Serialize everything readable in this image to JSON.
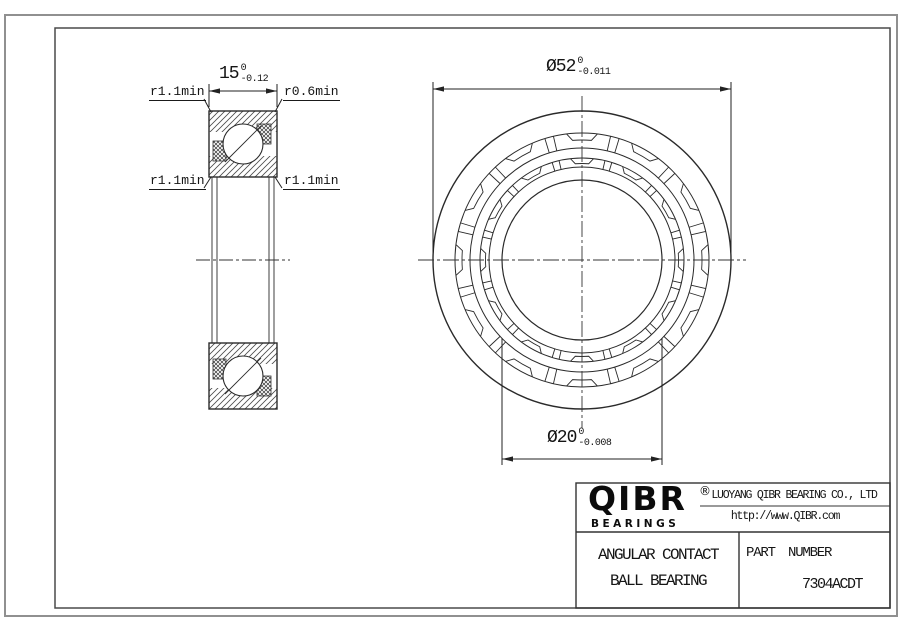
{
  "title_block": {
    "logo_text": "QIBR",
    "logo_registered": "®",
    "logo_subtext": "BEARINGS",
    "company_name": "LUOYANG QIBR BEARING CO., LTD",
    "company_url": "http://www.QIBR.com",
    "product_line1": "ANGULAR CONTACT",
    "product_line2": "BALL BEARING",
    "part_number_label": "PART NUMBER",
    "part_number": "7304ACDT"
  },
  "dimensions": {
    "width": {
      "value": "15",
      "tol_upper": "0",
      "tol_lower": "-0.12"
    },
    "outer_diameter": {
      "value": "Ø52",
      "tol_upper": "0",
      "tol_lower": "-0.011"
    },
    "bore_diameter": {
      "value": "Ø20",
      "tol_upper": "0",
      "tol_lower": "-0.008"
    }
  },
  "radius_labels": {
    "top_left": "r1.1min",
    "top_right": "r0.6min",
    "mid_left": "r1.1min",
    "mid_right": "r1.1min"
  },
  "front_view": {
    "cx": 582,
    "cy": 260,
    "pocket_count": 12,
    "divider_offset": 13,
    "radii": {
      "outer_diameter": 149,
      "outer_ring_inner": 127,
      "cage_outer": 112,
      "inner_ring_outer": 102,
      "cage_inner": 93,
      "bore": 80
    },
    "outer_band": {
      "outer": 127,
      "inner": 112,
      "floor": 120,
      "side_out": 7,
      "side_in": 4.5
    },
    "inner_band": {
      "outer": 102,
      "inner": 93,
      "floor": 96.5,
      "side_out": 6.5,
      "side_in": 4
    }
  },
  "colors": {
    "line": "#2a2a2a",
    "border_outer": "#909090",
    "border_inner": "#4a4a4a"
  }
}
